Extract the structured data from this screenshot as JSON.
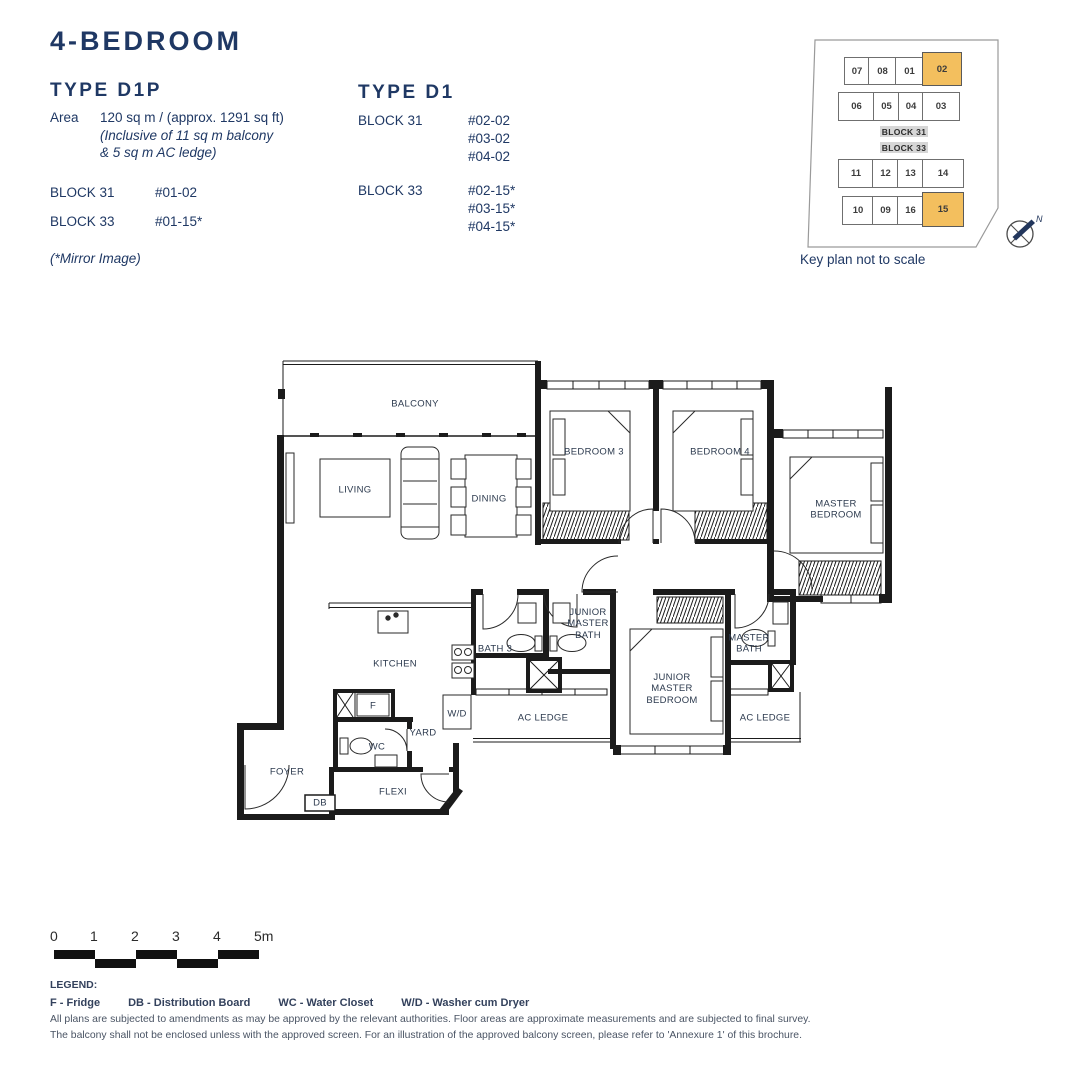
{
  "header": {
    "title": "4-BEDROOM"
  },
  "left_panel": {
    "heading": "TYPE D1P",
    "area_label": "Area",
    "area_value": "120 sq m / (approx. 1291 sq ft)",
    "area_note_line1": "(Inclusive of 11 sq m balcony",
    "area_note_line2": "& 5 sq m AC ledge)",
    "block1_name": "BLOCK 31",
    "block1_unit": "#01-02",
    "block2_name": "BLOCK 33",
    "block2_unit": "#01-15*",
    "mirror_note": "(*Mirror Image)"
  },
  "right_panel": {
    "heading": "TYPE D1",
    "block1_name": "BLOCK 31",
    "block1_units": [
      "#02-02",
      "#03-02",
      "#04-02"
    ],
    "block2_name": "BLOCK 33",
    "block2_units": [
      "#02-15*",
      "#03-15*",
      "#04-15*"
    ]
  },
  "keyplan": {
    "caption": "Key plan not to scale",
    "block31_label": "BLOCK 31",
    "block33_label": "BLOCK 33",
    "b31r1": [
      "07",
      "08",
      "01",
      "02"
    ],
    "b31r2": [
      "06",
      "05",
      "04",
      "03"
    ],
    "b33r1": [
      "11",
      "12",
      "13",
      "14"
    ],
    "b33r2": [
      "10",
      "09",
      "16",
      "15"
    ],
    "highlighted_units": [
      "02",
      "15"
    ],
    "compass_label": "N"
  },
  "floorplan": {
    "labels": {
      "balcony": "BALCONY",
      "living": "LIVING",
      "dining": "DINING",
      "bedroom3": "BEDROOM 3",
      "bedroom4": "BEDROOM 4",
      "master_bedroom": "MASTER BEDROOM",
      "junior_master_bath": "JUNIOR MASTER BATH",
      "bath3": "BATH 3",
      "kitchen": "KITCHEN",
      "junior_master_bedroom": "JUNIOR MASTER BEDROOM",
      "master_bath": "MASTER BATH",
      "ac_ledge_left": "AC LEDGE",
      "ac_ledge_right": "AC LEDGE",
      "wd": "W/D",
      "yard": "YARD",
      "wc": "WC",
      "fridge": "F",
      "foyer": "FOYER",
      "db": "DB",
      "flexi": "FLEXI"
    }
  },
  "scalebar": {
    "ticks": [
      "0",
      "1",
      "2",
      "3",
      "4",
      "5m"
    ]
  },
  "legend": {
    "heading": "LEGEND:",
    "items": [
      "F - Fridge",
      "DB - Distribution Board",
      "WC - Water Closet",
      "W/D - Washer cum Dryer"
    ]
  },
  "disclaimer": {
    "line1": "All plans are subjected to amendments as may be approved by the relevant authorities. Floor areas are approximate measurements and are subjected to final survey.",
    "line2": "The balcony shall not be enclosed unless with the approved screen. For an illustration of the approved balcony screen, please refer to 'Annexure 1' of this brochure."
  },
  "colors": {
    "navy": "#1f3864",
    "highlight": "#f3bf5e",
    "block_label_bg": "#d6d6d6",
    "wall": "#1b1b1b"
  }
}
